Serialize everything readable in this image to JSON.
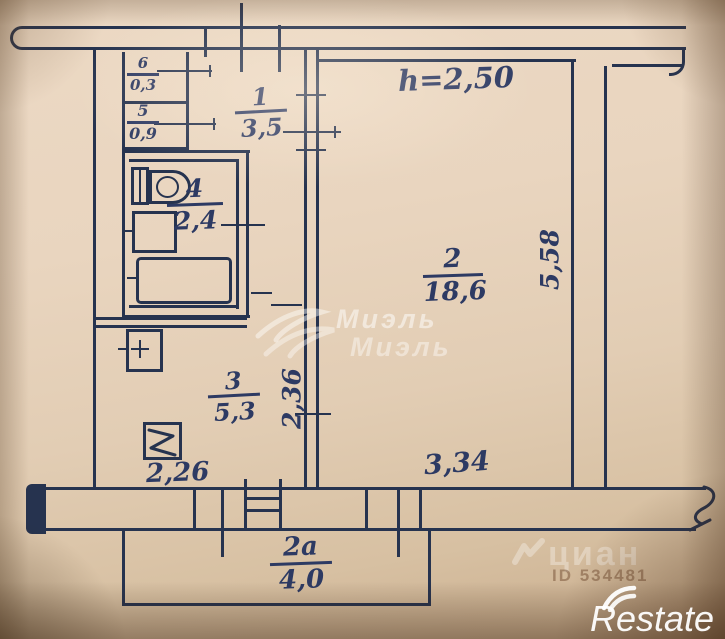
{
  "plan": {
    "ceiling_height_note": "h=2,50",
    "rooms": {
      "hallway": {
        "number": "1",
        "area": "3,5"
      },
      "living_room": {
        "number": "2",
        "area": "18,6"
      },
      "kitchen": {
        "number": "3",
        "area": "5,3"
      },
      "bathroom": {
        "number": "4",
        "area": "2,4"
      },
      "closet": {
        "number": "5",
        "area": "0,9"
      },
      "closet_small": {
        "number": "6",
        "area": "0,3"
      },
      "balcony": {
        "number": "2a",
        "area": "4,0"
      }
    },
    "dimensions": {
      "living_room_depth": "5,58",
      "living_room_width": "3,34",
      "kitchen_depth": "2,36",
      "kitchen_width": "2,26"
    }
  },
  "watermarks": {
    "agency": "Миэль",
    "portal": "циан",
    "portal_id": "ID 534481",
    "brand": "Restate"
  },
  "colors": {
    "ink": "#26334f",
    "paper": "#e4d1ba",
    "watermark_white": "#ffffff"
  }
}
